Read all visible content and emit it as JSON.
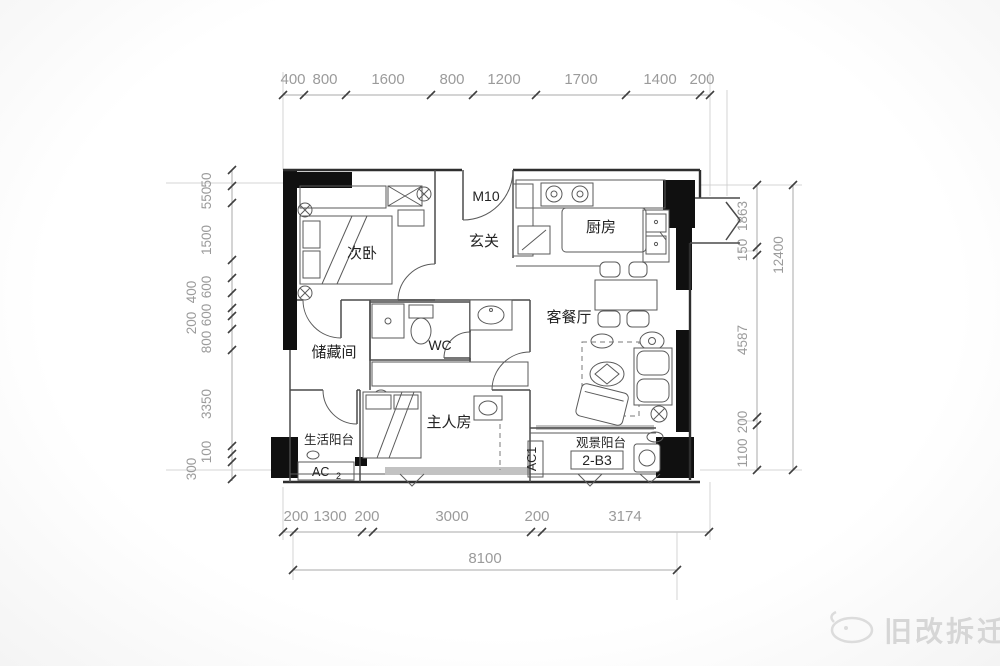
{
  "colors": {
    "wall": "#101010",
    "wall-line": "#2e2e2e",
    "line": "#4a4a4a",
    "furn": "#5a5a5a",
    "dim": "#a9a9a9",
    "dim-text": "#9b9b9b",
    "label": "#232323",
    "watermark": "#d6d6d6"
  },
  "dimensions": {
    "top": [
      "400",
      "800",
      "1600",
      "800",
      "1200",
      "1700",
      "1400",
      "200"
    ],
    "left": [
      "50",
      "550",
      "1500",
      "600",
      "400",
      "600",
      "200",
      "800",
      "3350",
      "100",
      "300"
    ],
    "right_inner": [
      "1863",
      "150",
      "4587",
      "200",
      "1100"
    ],
    "right_overall": "12400",
    "bottom": [
      "200",
      "1300",
      "200",
      "3000",
      "200",
      "3174"
    ],
    "bottom_overall": "8100"
  },
  "rooms": {
    "second_bedroom": "次卧",
    "foyer": "玄关",
    "kitchen": "厨房",
    "living_dining": "客餐厅",
    "storage": "储藏间",
    "wc": "WC",
    "master_bedroom": "主人房",
    "service_balcony": "生活阳台",
    "view_balcony": "观景阳台"
  },
  "labels": {
    "entry_door": "M10",
    "unit": "2-B3",
    "ac1": "AC1",
    "ac2": "AC",
    "ac2_num": "2"
  },
  "watermark": {
    "text": "旧改拆迁"
  }
}
